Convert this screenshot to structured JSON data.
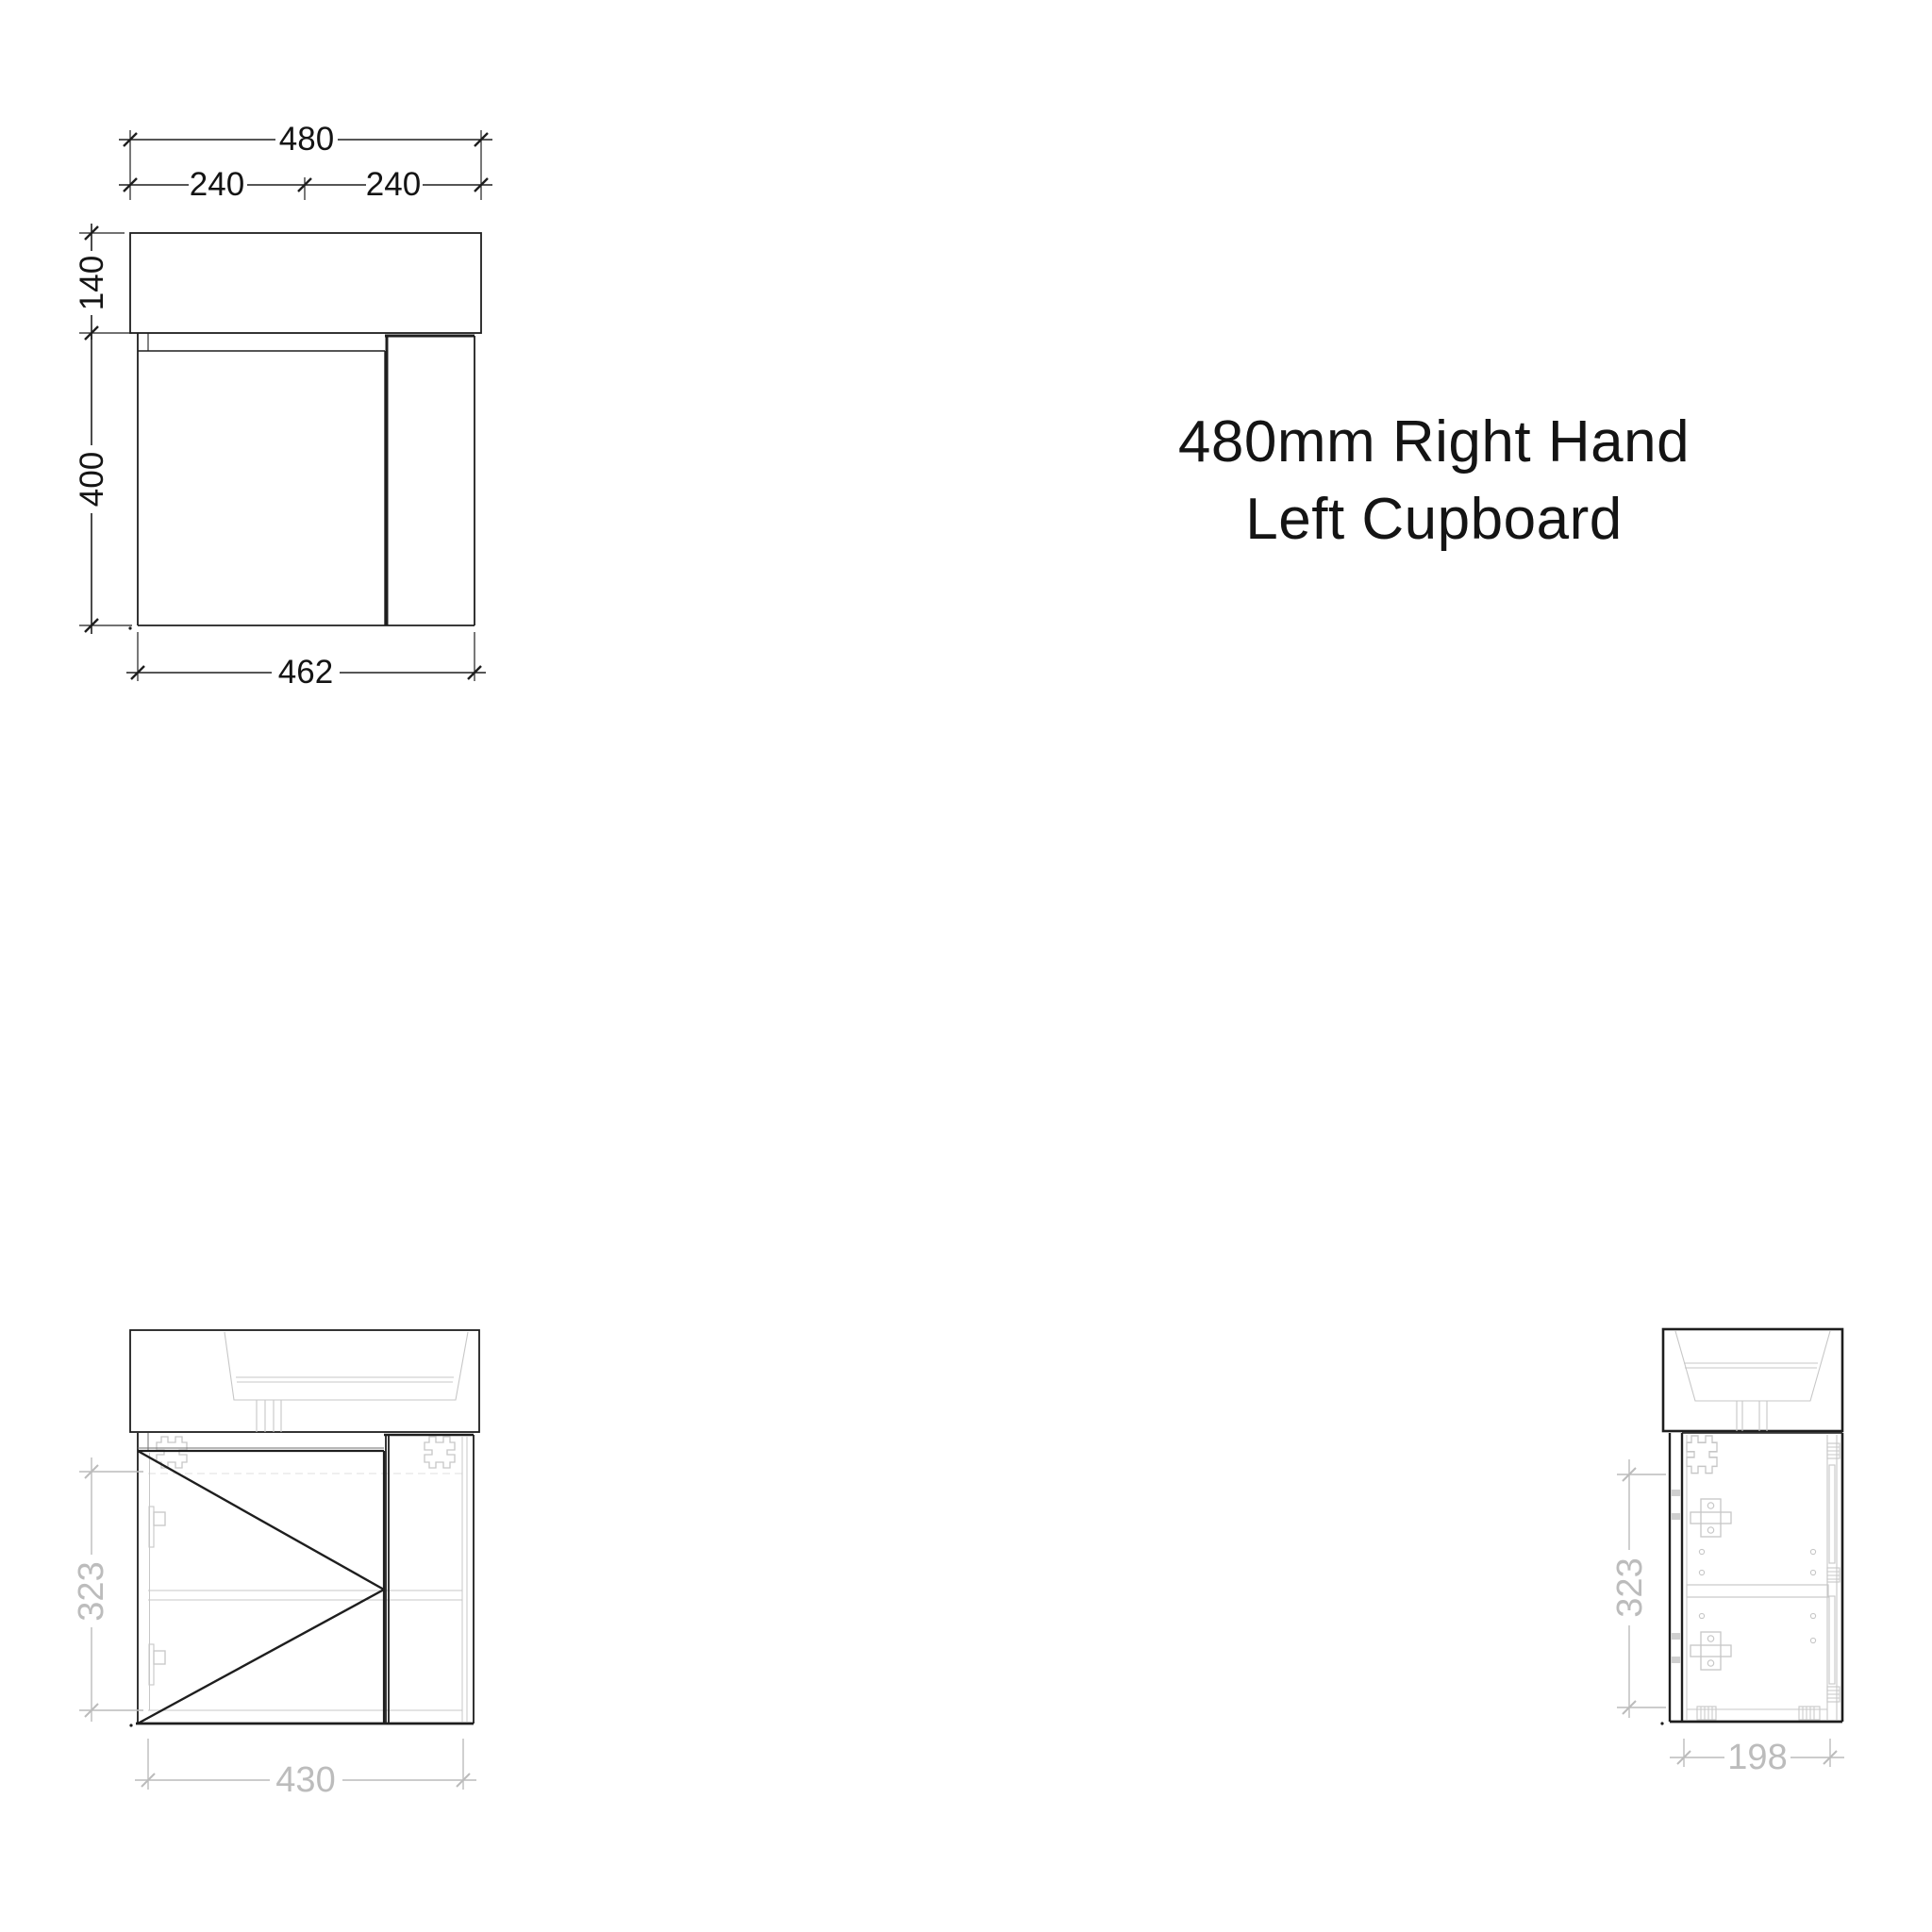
{
  "title": {
    "line1": "480mm Right Hand",
    "line2": "Left Cupboard"
  },
  "views": {
    "front_elevation": {
      "dims": {
        "overall_width": "480",
        "left_half": "240",
        "right_half": "240",
        "top_height": "140",
        "cabinet_height": "400",
        "cabinet_width": "462"
      }
    },
    "front_internal": {
      "dims": {
        "side_height": "323",
        "bottom_width": "430"
      }
    },
    "side_internal": {
      "dims": {
        "side_height": "323",
        "bottom_depth": "198"
      }
    }
  },
  "colors": {
    "line_dark": "#1e1e1e",
    "line_medium": "#6f6f6f",
    "line_light": "#c7c7c7",
    "line_faint": "#dfdfdf",
    "dim_gray": "#bcbcbc",
    "text_black": "#141414",
    "background": "#ffffff"
  }
}
